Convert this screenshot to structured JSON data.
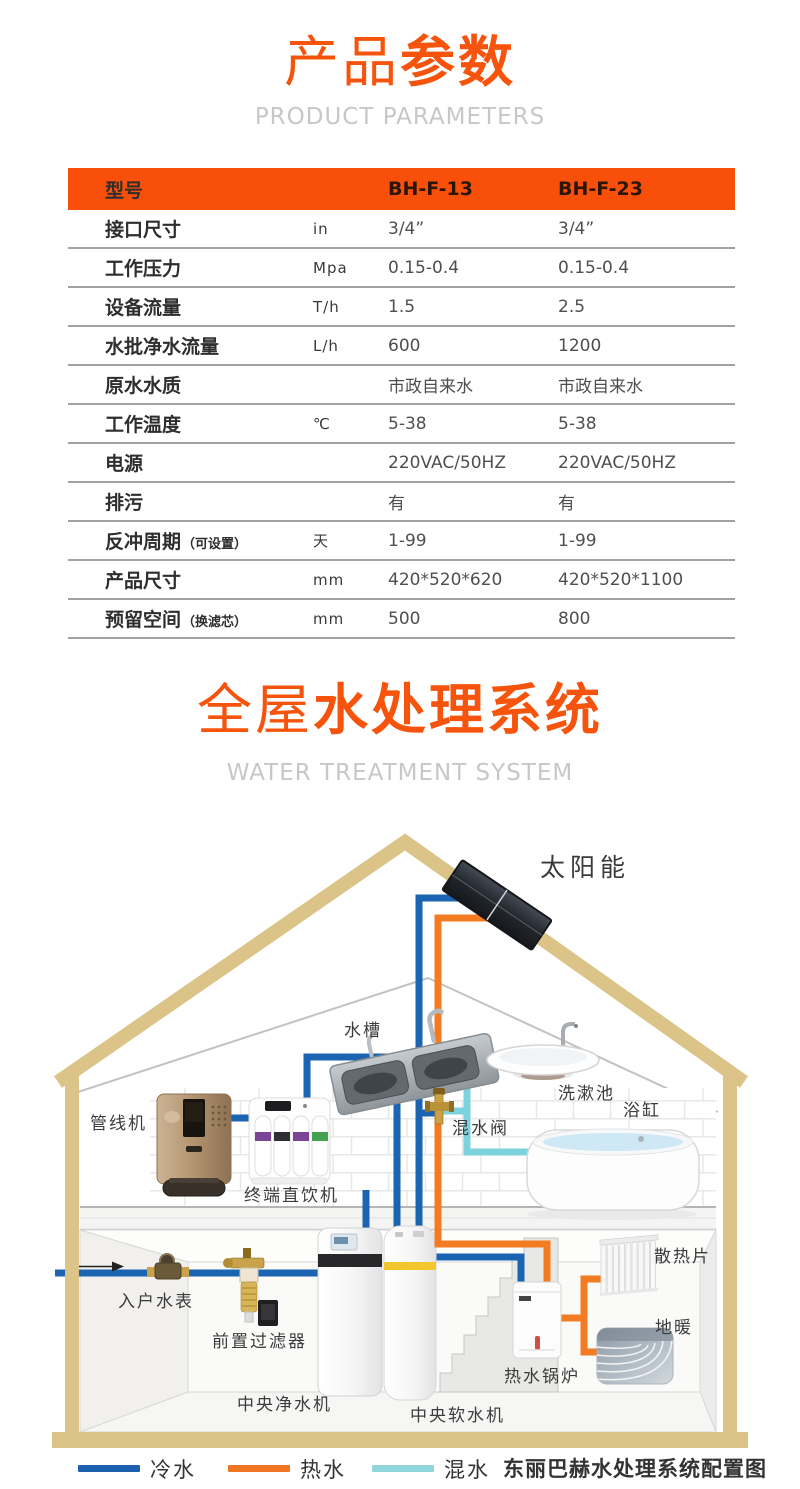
{
  "section1": {
    "title_light": "产品",
    "title_bold": "参数",
    "subtitle": "PRODUCT PARAMETERS"
  },
  "table": {
    "header": {
      "col_model": "型号",
      "col_a": "BH-F-13",
      "col_b": "BH-F-23"
    },
    "rows": [
      {
        "label": "接口尺寸",
        "note": "",
        "unit": "in",
        "a": "3/4”",
        "b": "3/4”"
      },
      {
        "label": "工作压力",
        "note": "",
        "unit": "Mpa",
        "a": "0.15-0.4",
        "b": "0.15-0.4"
      },
      {
        "label": "设备流量",
        "note": "",
        "unit": "T/h",
        "a": "1.5",
        "b": "2.5"
      },
      {
        "label": "水批净水流量",
        "note": "",
        "unit": "L/h",
        "a": "600",
        "b": "1200"
      },
      {
        "label": "原水水质",
        "note": "",
        "unit": "",
        "a": "市政自来水",
        "b": "市政自来水"
      },
      {
        "label": "工作温度",
        "note": "",
        "unit": "℃",
        "a": "5-38",
        "b": "5-38"
      },
      {
        "label": "电源",
        "note": "",
        "unit": "",
        "a": "220VAC/50HZ",
        "b": "220VAC/50HZ"
      },
      {
        "label": "排污",
        "note": "",
        "unit": "",
        "a": "有",
        "b": "有"
      },
      {
        "label": "反冲周期",
        "note": "（可设置）",
        "unit": "天",
        "a": "1-99",
        "b": "1-99"
      },
      {
        "label": "产品尺寸",
        "note": "",
        "unit": "mm",
        "a": "420*520*620",
        "b": "420*520*1100"
      },
      {
        "label": "预留空间",
        "note": "（换滤芯）",
        "unit": "mm",
        "a": "500",
        "b": "800"
      }
    ]
  },
  "section2": {
    "title_light": "全屋",
    "title_bold": "水处理系统",
    "subtitle": "WATER TREATMENT SYSTEM"
  },
  "diagram": {
    "labels": {
      "solar": "太阳能",
      "sink": "水槽",
      "pipeline_machine": "管线机",
      "terminal_purifier": "终端直饮机",
      "mixing_valve": "混水阀",
      "wash_basin": "洗漱池",
      "bathtub": "浴缸",
      "water_meter": "入户水表",
      "pre_filter": "前置过滤器",
      "central_purifier": "中央净水机",
      "central_softener": "中央软水机",
      "boiler": "热水锅炉",
      "radiator": "散热片",
      "floor_heating": "地暖"
    }
  },
  "legend": {
    "cold": "冷水",
    "hot": "热水",
    "mixed": "混水",
    "caption": "东丽巴赫水处理系统配置图"
  },
  "colors": {
    "accent": "#f8500b",
    "cold": "#1b64b1",
    "hot": "#f37b21",
    "mixed": "#7ed2dd",
    "roof": "#dcc488"
  }
}
